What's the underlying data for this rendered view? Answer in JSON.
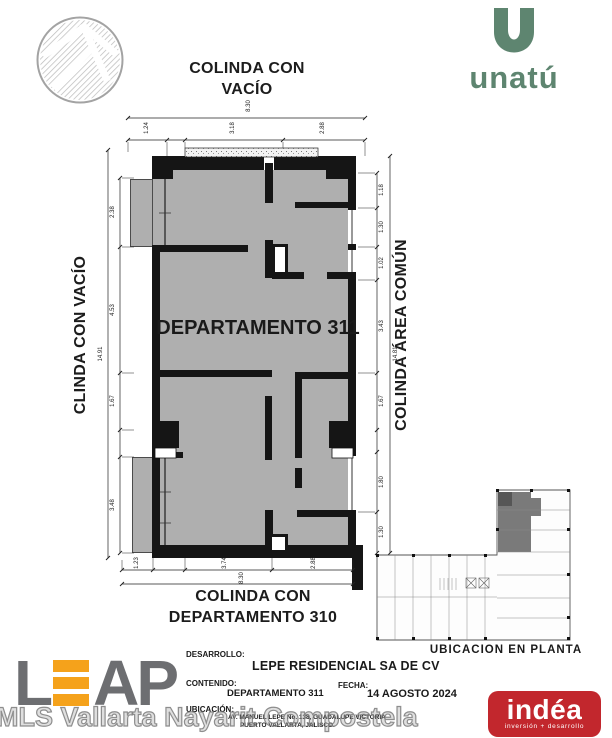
{
  "labels": {
    "top_line1": "COLINDA CON",
    "top_line2": "VACÍO",
    "left": "CLINDA CON VACÍO",
    "right": "COLINDA ÁREA COMÚN",
    "bottom_line1": "COLINDA CON",
    "bottom_line2": "DEPARTAMENTO 310"
  },
  "plan": {
    "room_label": "DEPARTAMENTO 311",
    "dims": {
      "top_overall": "8.30",
      "top": [
        "1.24",
        "3.18",
        "2.88"
      ],
      "left_overall": "14.91",
      "left": [
        "2.38",
        "4.53",
        "1.67",
        "3.48"
      ],
      "right_overall": "14.81",
      "right": [
        "1.18",
        "1.30",
        "1.02",
        "3.43",
        "1.67",
        "1.80",
        "1.30"
      ],
      "bottom_overall": "8.30",
      "bottom": [
        "1.23",
        "3.74",
        "2.88"
      ]
    }
  },
  "mini_plan": {
    "caption": "UBICACION EN PLANTA"
  },
  "brand": {
    "unatu_wordmark": "unatú",
    "unatu_green": "#5E8570",
    "leap_l": "L",
    "leap_a": "A",
    "leap_p": "P",
    "leap_gray": "#6D6E71",
    "leap_orange": "#F5A21B",
    "indea_wordmark": "indéa",
    "indea_tagline": "inversión + desarrollo",
    "indea_red": "#C2272D"
  },
  "titleblock": {
    "desarrollo_label": "DESARROLLO:",
    "desarrollo_value": "LEPE RESIDENCIAL SA DE CV",
    "contenido_label": "CONTENIDO:",
    "contenido_value": "DEPARTAMENTO 311",
    "fecha_label": "FECHA:",
    "fecha_value": "14 AGOSTO 2024",
    "ubicacion_label": "UBICACIÓN:",
    "ubicacion_line1": "AV. MANUEL LEPE No. 138, GUADALUPE VICTORIA",
    "ubicacion_line2": "PUERTO VALLARTA, JALISCO."
  },
  "watermark": {
    "text": "MLS Vallarta Nayarit Compostela"
  }
}
